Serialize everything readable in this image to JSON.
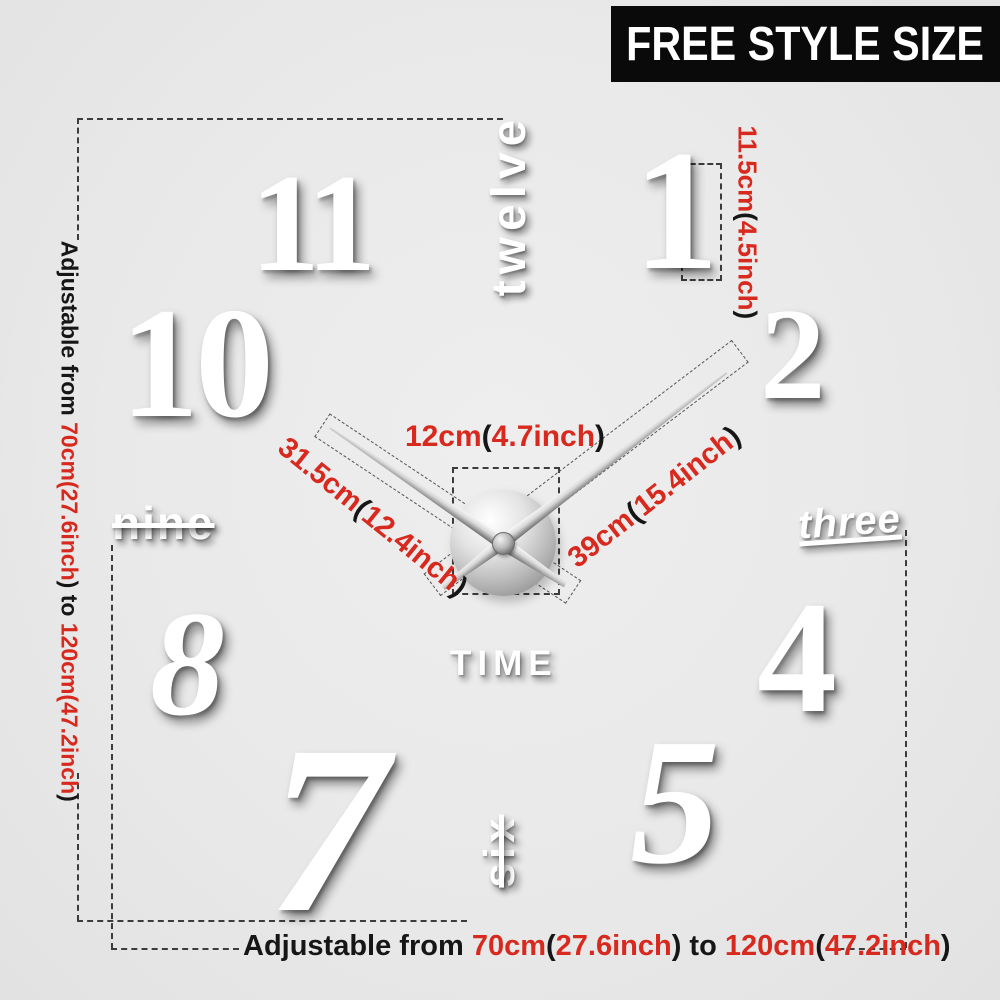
{
  "banner": {
    "label": "FREE STYLE SIZE",
    "bg": "#0a0a0a",
    "fg": "#ffffff"
  },
  "colors": {
    "red": "#d8291e",
    "black": "#161616",
    "numeral": "#ffffff",
    "background": "#e9e9e9"
  },
  "clock": {
    "numerals": {
      "eleven": "11",
      "twelve": "twelve",
      "one": "1",
      "ten": "10",
      "two": "2",
      "nine": "nine",
      "three": "three",
      "eight": "8",
      "four": "4",
      "seven": "7",
      "six": "six",
      "five": "5"
    },
    "center_label": "TIME"
  },
  "measurements": {
    "hub_width": {
      "parts": [
        {
          "t": "12cm",
          "c": "red"
        },
        {
          "t": "(",
          "c": "blk"
        },
        {
          "t": "4.7inch",
          "c": "red"
        },
        {
          "t": ")",
          "c": "blk"
        }
      ]
    },
    "hour_hand_length": {
      "parts": [
        {
          "t": "31.5cm",
          "c": "red"
        },
        {
          "t": "(",
          "c": "blk"
        },
        {
          "t": "12.4inch",
          "c": "red"
        },
        {
          "t": ")",
          "c": "blk"
        }
      ]
    },
    "minute_hand_length": {
      "parts": [
        {
          "t": "39cm",
          "c": "red"
        },
        {
          "t": "(",
          "c": "blk"
        },
        {
          "t": "15.4inch",
          "c": "red"
        },
        {
          "t": ")",
          "c": "blk"
        }
      ]
    },
    "numeral_height": {
      "parts": [
        {
          "t": "11.5cm",
          "c": "red"
        },
        {
          "t": "(",
          "c": "blk"
        },
        {
          "t": "4.5inch",
          "c": "red"
        },
        {
          "t": ")",
          "c": "blk"
        }
      ]
    },
    "adjustable_side": {
      "parts": [
        {
          "t": "Adjustable from ",
          "c": "blk"
        },
        {
          "t": "70cm(27.6inch",
          "c": "red"
        },
        {
          "t": ") to ",
          "c": "blk"
        },
        {
          "t": "120cm(47.2inch",
          "c": "red"
        },
        {
          "t": ")",
          "c": "blk"
        }
      ]
    },
    "adjustable_bottom": {
      "parts": [
        {
          "t": "Adjustable from ",
          "c": "blk"
        },
        {
          "t": "70cm",
          "c": "red"
        },
        {
          "t": "(",
          "c": "blk"
        },
        {
          "t": "27.6inch",
          "c": "red"
        },
        {
          "t": ") to ",
          "c": "blk"
        },
        {
          "t": "120cm",
          "c": "red"
        },
        {
          "t": "(",
          "c": "blk"
        },
        {
          "t": "47.2inch",
          "c": "red"
        },
        {
          "t": ")",
          "c": "blk"
        }
      ]
    }
  }
}
